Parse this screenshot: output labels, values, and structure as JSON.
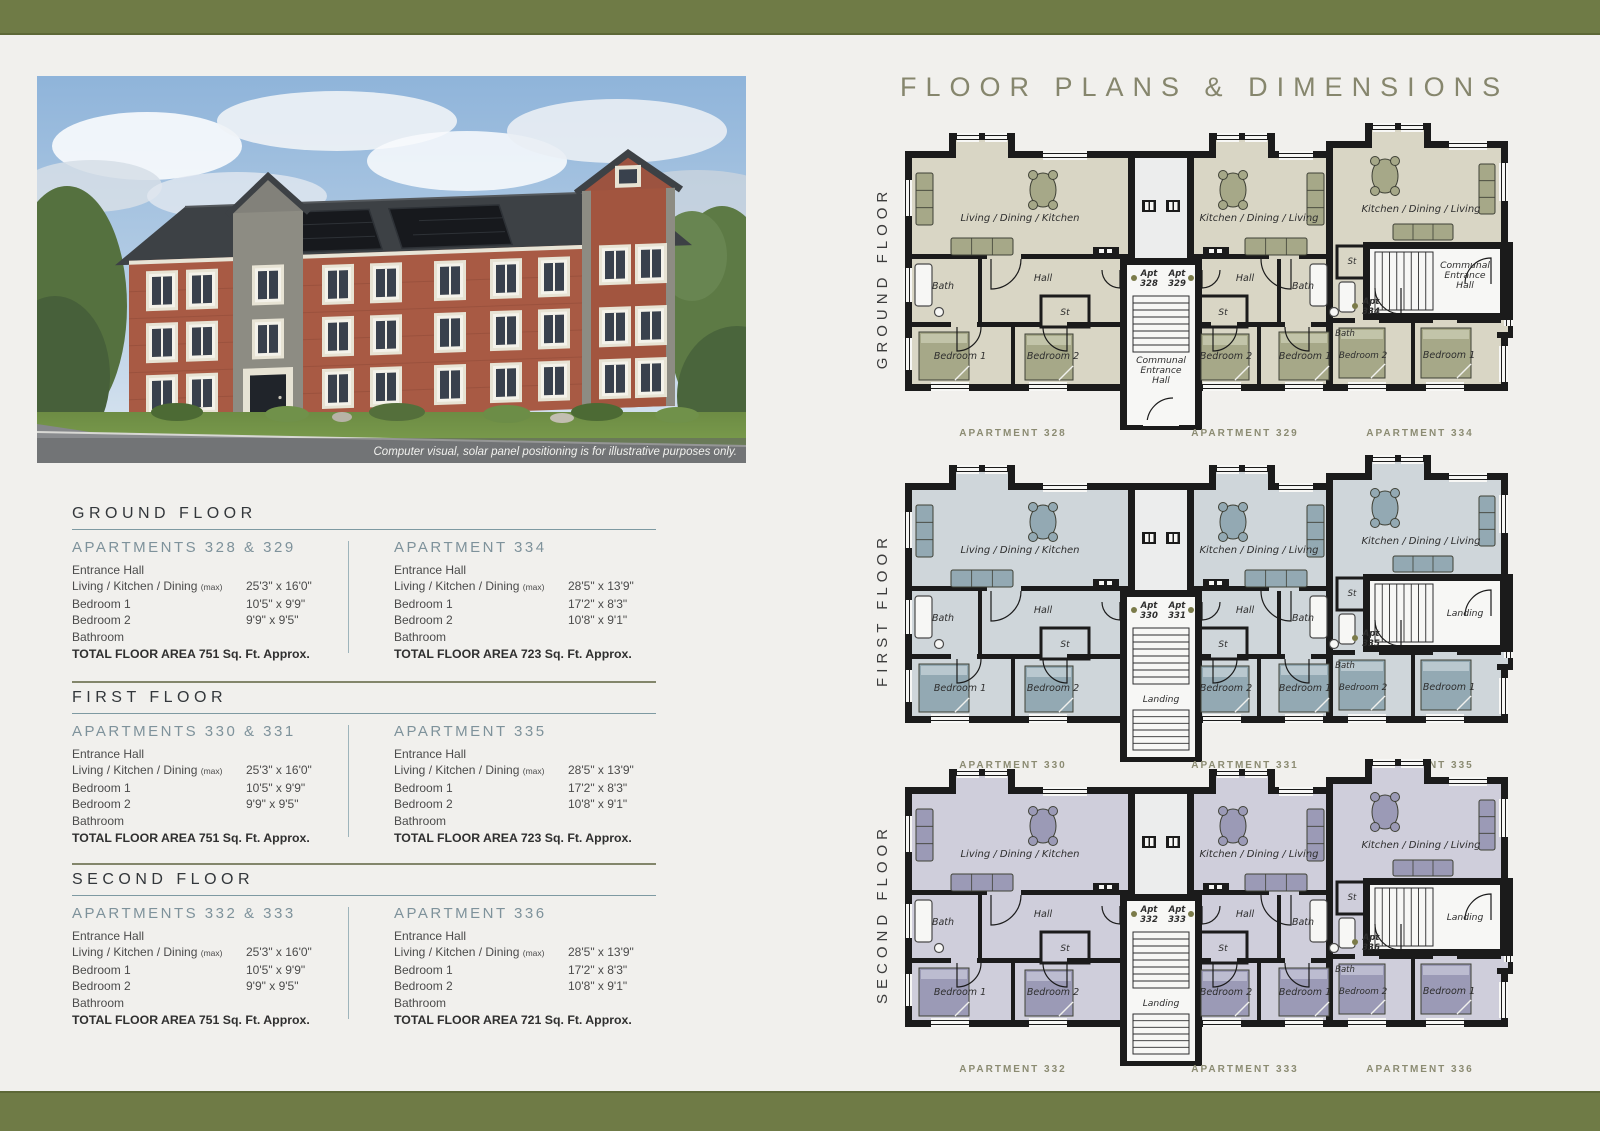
{
  "colors": {
    "bar_olive": "#6f7b46",
    "rule_teal": "#7e9aa2",
    "rule_olive": "#83866b",
    "heading_slate": "#7e929b",
    "caption_olive": "#8b8b72",
    "title_olive": "#86866d",
    "wall_black": "#1b1b1b",
    "apt_dot_olive": "#7b7b49"
  },
  "title": "FLOOR PLANS & DIMENSIONS",
  "photo": {
    "caption": "Computer visual, solar panel positioning is for illustrative purposes only."
  },
  "specs": {
    "sections": [
      {
        "heading": "GROUND FLOOR",
        "columns": [
          {
            "heading": "APARTMENTS 328 & 329",
            "rows": [
              {
                "label": "Entrance Hall",
                "value": ""
              },
              {
                "label": "Living / Kitchen / Dining",
                "note": "(max)",
                "value": "25'3\" x 16'0\""
              },
              {
                "label": "Bedroom 1",
                "value": "10'5\" x 9'9\""
              },
              {
                "label": "Bedroom 2",
                "value": "9'9\" x 9'5\""
              },
              {
                "label": "Bathroom",
                "value": ""
              }
            ],
            "total": "TOTAL FLOOR AREA 751 Sq. Ft. Approx."
          },
          {
            "heading": "APARTMENT 334",
            "rows": [
              {
                "label": "Entrance Hall",
                "value": ""
              },
              {
                "label": "Living / Kitchen / Dining",
                "note": "(max)",
                "value": "28'5\" x 13'9\""
              },
              {
                "label": "Bedroom 1",
                "value": "17'2\" x 8'3\""
              },
              {
                "label": "Bedroom 2",
                "value": "10'8\" x 9'1\""
              },
              {
                "label": "Bathroom",
                "value": ""
              }
            ],
            "total": "TOTAL FLOOR AREA 723 Sq. Ft. Approx."
          }
        ]
      },
      {
        "heading": "FIRST FLOOR",
        "columns": [
          {
            "heading": "APARTMENTS 330 & 331",
            "rows": [
              {
                "label": "Entrance Hall",
                "value": ""
              },
              {
                "label": "Living / Kitchen / Dining",
                "note": "(max)",
                "value": "25'3\" x 16'0\""
              },
              {
                "label": "Bedroom 1",
                "value": "10'5\" x 9'9\""
              },
              {
                "label": "Bedroom 2",
                "value": "9'9\" x 9'5\""
              },
              {
                "label": "Bathroom",
                "value": ""
              }
            ],
            "total": "TOTAL FLOOR AREA 751 Sq. Ft. Approx."
          },
          {
            "heading": "APARTMENT 335",
            "rows": [
              {
                "label": "Entrance Hall",
                "value": ""
              },
              {
                "label": "Living / Kitchen / Dining",
                "note": "(max)",
                "value": "28'5\" x 13'9\""
              },
              {
                "label": "Bedroom 1",
                "value": "17'2\" x 8'3\""
              },
              {
                "label": "Bedroom 2",
                "value": "10'8\" x 9'1\""
              },
              {
                "label": "Bathroom",
                "value": ""
              }
            ],
            "total": "TOTAL FLOOR AREA 723 Sq. Ft. Approx."
          }
        ]
      },
      {
        "heading": "SECOND FLOOR",
        "columns": [
          {
            "heading": "APARTMENTS 332 & 333",
            "rows": [
              {
                "label": "Entrance Hall",
                "value": ""
              },
              {
                "label": "Living / Kitchen / Dining",
                "note": "(max)",
                "value": "25'3\" x 16'0\""
              },
              {
                "label": "Bedroom 1",
                "value": "10'5\" x 9'9\""
              },
              {
                "label": "Bedroom 2",
                "value": "9'9\" x 9'5\""
              },
              {
                "label": "Bathroom",
                "value": ""
              }
            ],
            "total": "TOTAL FLOOR AREA 751 Sq. Ft. Approx."
          },
          {
            "heading": "APARTMENT 336",
            "rows": [
              {
                "label": "Entrance Hall",
                "value": ""
              },
              {
                "label": "Living / Kitchen / Dining",
                "note": "(max)",
                "value": "28'5\" x 13'9\""
              },
              {
                "label": "Bedroom 1",
                "value": "17'2\" x 8'3\""
              },
              {
                "label": "Bedroom 2",
                "value": "10'8\" x 9'1\""
              },
              {
                "label": "Bathroom",
                "value": ""
              }
            ],
            "total": "TOTAL FLOOR AREA 721 Sq. Ft. Approx."
          }
        ]
      }
    ]
  },
  "plans": {
    "shared": {
      "hall": "Hall",
      "bath": "Bath",
      "st": "St",
      "bed1": "Bedroom 1",
      "bed2": "Bedroom 2",
      "unit_left_main": "Living / Dining / Kitchen",
      "unit_mid_main": "Kitchen / Dining / Living",
      "unit_right_main": "Kitchen / Dining / Living"
    },
    "floors": [
      {
        "side_label": "GROUND FLOOR",
        "fill": "#d9d6c5",
        "furniture": "#a6a888",
        "furniture_light": "#c2c4a9",
        "apt_tags": [
          [
            "Apt",
            "328"
          ],
          [
            "Apt",
            "329"
          ],
          [
            "Apt",
            "334"
          ]
        ],
        "center_core": [
          "Communal",
          "Entrance",
          "Hall"
        ],
        "right_core": [
          "Communal",
          "Entrance",
          "Hall"
        ],
        "captions": [
          "APARTMENT 328",
          "APARTMENT 329",
          "APARTMENT 334"
        ],
        "entry_door": true
      },
      {
        "side_label": "FIRST FLOOR",
        "fill": "#cfd6da",
        "furniture": "#93a9b3",
        "furniture_light": "#b9c8cf",
        "apt_tags": [
          [
            "Apt",
            "330"
          ],
          [
            "Apt",
            "331"
          ],
          [
            "Apt",
            "335"
          ]
        ],
        "center_core": [
          "Landing"
        ],
        "right_core": [
          "Landing"
        ],
        "captions": [
          "APARTMENT 330",
          "APARTMENT 331",
          "APARTMENT 335"
        ],
        "entry_door": false
      },
      {
        "side_label": "SECOND FLOOR",
        "fill": "#cfcedb",
        "furniture": "#9b9ab6",
        "furniture_light": "#bcbcd0",
        "apt_tags": [
          [
            "Apt",
            "332"
          ],
          [
            "Apt",
            "333"
          ],
          [
            "Apt",
            "336"
          ]
        ],
        "center_core": [
          "Landing"
        ],
        "right_core": [
          "Landing"
        ],
        "captions": [
          "APARTMENT 332",
          "APARTMENT 333",
          "APARTMENT 336"
        ],
        "entry_door": false
      }
    ]
  }
}
